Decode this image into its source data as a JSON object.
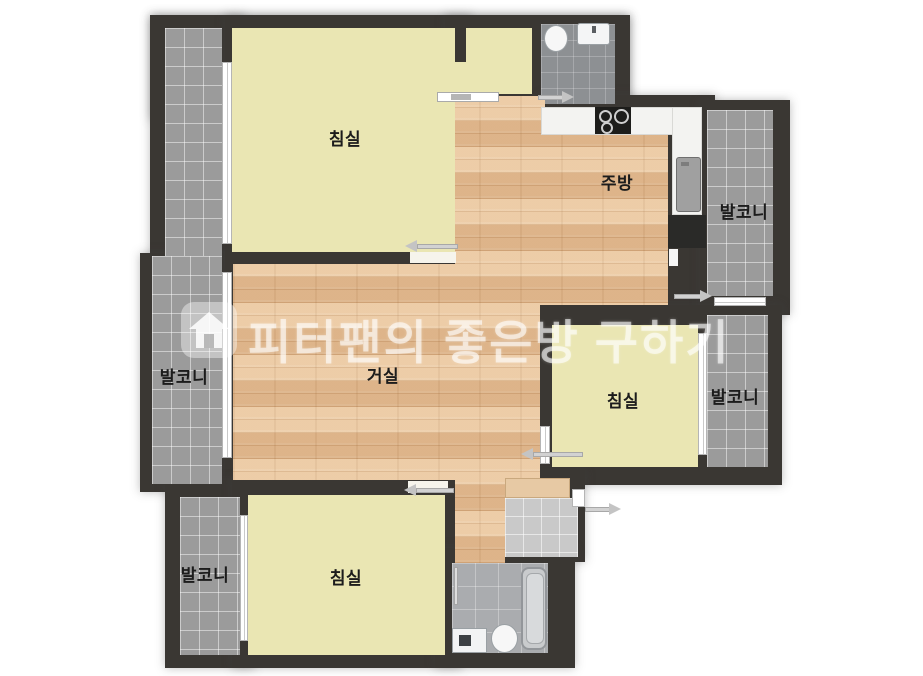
{
  "floorplan": {
    "title_watermark": {
      "icon": "house-icon",
      "text": "피터팬의 좋은방 구하기"
    },
    "rooms": [
      {
        "name": "bedroom-top-left",
        "label": "침실"
      },
      {
        "name": "living-room",
        "label": "거실"
      },
      {
        "name": "kitchen",
        "label": "주방"
      },
      {
        "name": "bedroom-mid-right",
        "label": "침실"
      },
      {
        "name": "bedroom-bottom",
        "label": "침실"
      },
      {
        "name": "balcony-left",
        "label": "발코니"
      },
      {
        "name": "balcony-top-right",
        "label": "발코니"
      },
      {
        "name": "balcony-mid-right",
        "label": "발코니"
      },
      {
        "name": "balcony-bottom-left",
        "label": "발코니"
      }
    ],
    "fixtures": [
      {
        "name": "toilet",
        "location": "top-bathroom"
      },
      {
        "name": "sink",
        "location": "top-bathroom"
      },
      {
        "name": "stove-cooktop",
        "location": "kitchen"
      },
      {
        "name": "refrigerator",
        "location": "kitchen"
      },
      {
        "name": "shoe-cabinet",
        "location": "entry"
      },
      {
        "name": "bathtub",
        "location": "bottom-bathroom"
      },
      {
        "name": "toilet",
        "location": "bottom-bathroom"
      },
      {
        "name": "washbasin",
        "location": "bottom-bathroom"
      }
    ],
    "colors": {
      "wall": "#3a3733",
      "bedroom_fill": "#eae6b3",
      "wood_floor": "#e9c69e",
      "balcony_tile": "#9b9b9b",
      "bathroom_tile_dark": "#8d9093",
      "bathroom_tile_light": "#aaacaf",
      "entry_tile": "#c9c9c9",
      "counter": "#f3f3f1",
      "watermark": "#ffffff"
    }
  }
}
